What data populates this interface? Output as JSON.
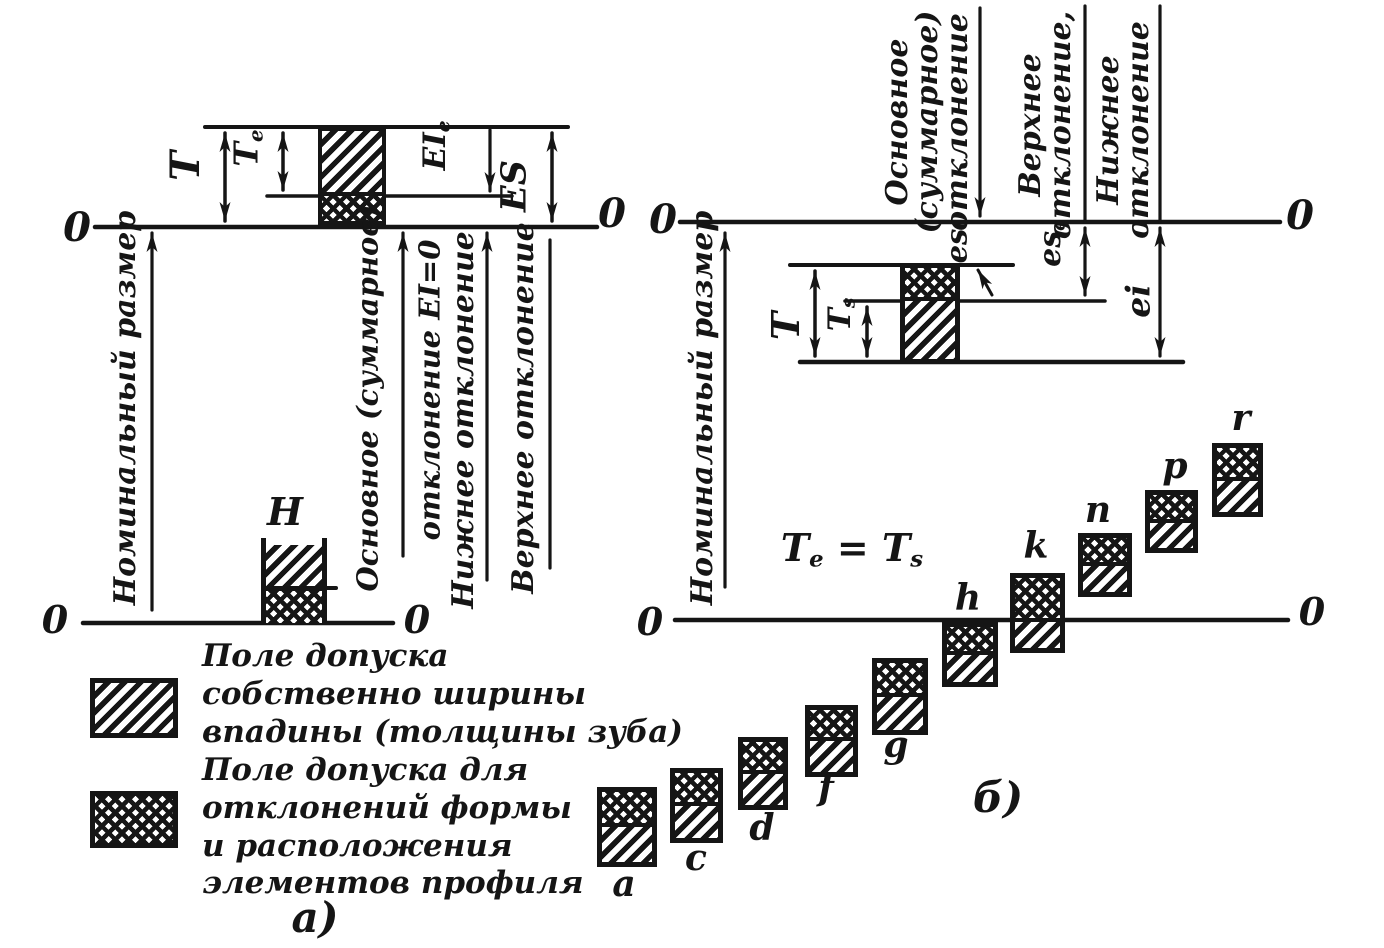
{
  "panel_a": {
    "zero_top_left": "0",
    "zero_top_right": "0",
    "zero_bottom_left": "0",
    "zero_bottom_right": "0",
    "t": "T",
    "te_base": "T",
    "te_sub": "e",
    "eie_base": "EI",
    "eie_sub": "e",
    "es": "ES",
    "h": "H",
    "nominal": "Номинальный размер",
    "osnovnoe_line1": "Основное (суммарное)",
    "osnovnoe_line2": "отклонение EI=0",
    "nizhnee": "Нижнее отклонение",
    "verkhnee": "Верхнее отклонение",
    "caption": "а)"
  },
  "legend": {
    "item1_lines": "Поле допуска\nсобственно ширины\nвпадины (толщины зуба)",
    "item1_swatch": "diagonal-hatch",
    "item2_lines": "Поле допуска для\nотклонений формы\nи расположения\nэлементов профиля",
    "item2_swatch": "cross-hatch"
  },
  "panel_b": {
    "zero_top_left": "0",
    "zero_top_right": "0",
    "zero_bottom_left": "0",
    "zero_bottom_right": "0",
    "osnovnoe": "Основное\n(суммарное)\nотклонение",
    "verkhnee": "Верхнее\nотклонение,",
    "nizhnee": "Нижнее\nотклонение",
    "nominal": "Номинальный размер",
    "es": "es",
    "ese_base": "es",
    "ese_sub": "e",
    "ei": "ei",
    "t": "T",
    "ts_base": "T",
    "ts_sub": "s",
    "eq_t1": "T",
    "eq_sub1": "e",
    "eq_mid": " = T",
    "eq_sub2": "s",
    "caption": "б)",
    "series_labels": [
      "a",
      "c",
      "d",
      "f",
      "g",
      "h",
      "k",
      "n",
      "p",
      "r"
    ]
  },
  "colors": {
    "ink": "#151515",
    "paper": "#ffffff"
  }
}
